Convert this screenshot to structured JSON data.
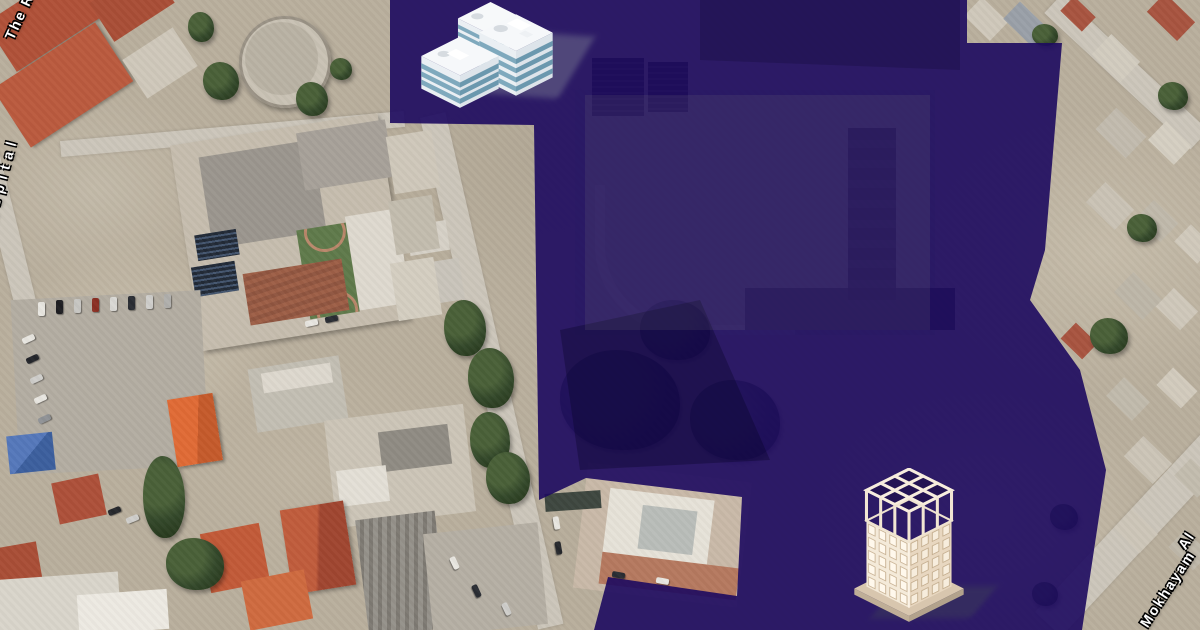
{
  "map": {
    "labels": {
      "top_left_road": "The R",
      "left_road": "Hospital",
      "bottom_right_road": "Mokhayam",
      "bottom_right_road_next_word": "Al"
    },
    "overlay": {
      "color": "#1d0a5f",
      "opacity": "0.9"
    },
    "markers": {
      "north": "office-building-3d-icon",
      "south": "construction-apartment-3d-icon"
    },
    "palette": {
      "label_text": "#ffffff",
      "label_outline": "#000000",
      "satellite_ground": "#b9af9d",
      "red_roof": "#b05138",
      "tree_green": "#33482a"
    }
  }
}
